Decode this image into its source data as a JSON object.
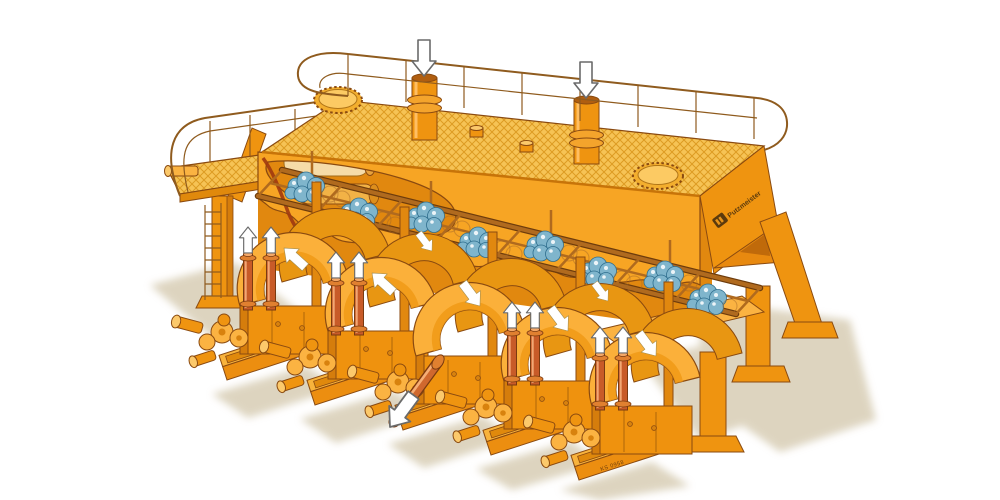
{
  "scene": {
    "description": "Isometric cutaway technical illustration of a five-unit industrial piston pump station painted orange, with top service platform, inlet pipes, diaphragm valve rack and ground shadow",
    "background_color": "#FFFFFF"
  },
  "branding": {
    "logo_mark": "PM",
    "logo_text": "Putzmeister"
  },
  "markings": {
    "part_number": "KS 0958"
  },
  "palette": {
    "machine_orange": "#F7A524",
    "machine_orange_dark": "#E1880F",
    "deck_yellow": "#F6C355",
    "mesh_line": "#DD9B22",
    "outline_brown": "#8A4A10",
    "railing_brown": "#8F5B1E",
    "riser_pipe_red": "#C85B28",
    "diaphragm_blue": "#7FB5CC",
    "diaphragm_blue_dark": "#2F6E8E",
    "ground_shadow_tan": "#D5CAB0",
    "arrow_white": "#FFFFFF"
  },
  "platform": {
    "manhole_covers": 2,
    "inlet_pipes": 2,
    "inlet_flow_direction": "down",
    "guardrail_posts": 8,
    "side_balcony": true,
    "access_ladder": true
  },
  "valve_rack": {
    "window_frames": 8,
    "diaphragm_ball_clusters": 8,
    "ghost_outline_circles": true
  },
  "pump_stations": {
    "count": 5,
    "stations": [
      {
        "id": 1,
        "riser_pipes": 2,
        "riser_flow": "up",
        "drum_flow": "up-left"
      },
      {
        "id": 2,
        "riser_pipes": 2,
        "riser_flow": "up",
        "drum_flow": "up-left"
      },
      {
        "id": 3,
        "riser_pipes": 0,
        "discharge_pipe": "down-left outward",
        "drum_flow": "down-right"
      },
      {
        "id": 4,
        "riser_pipes": 2,
        "riser_flow": "up",
        "drum_flow": "down-right"
      },
      {
        "id": 5,
        "riser_pipes": 2,
        "riser_flow": "up",
        "drum_flow": "down-right"
      }
    ]
  },
  "supports": {
    "right_legs": 3,
    "left_column": 1
  }
}
